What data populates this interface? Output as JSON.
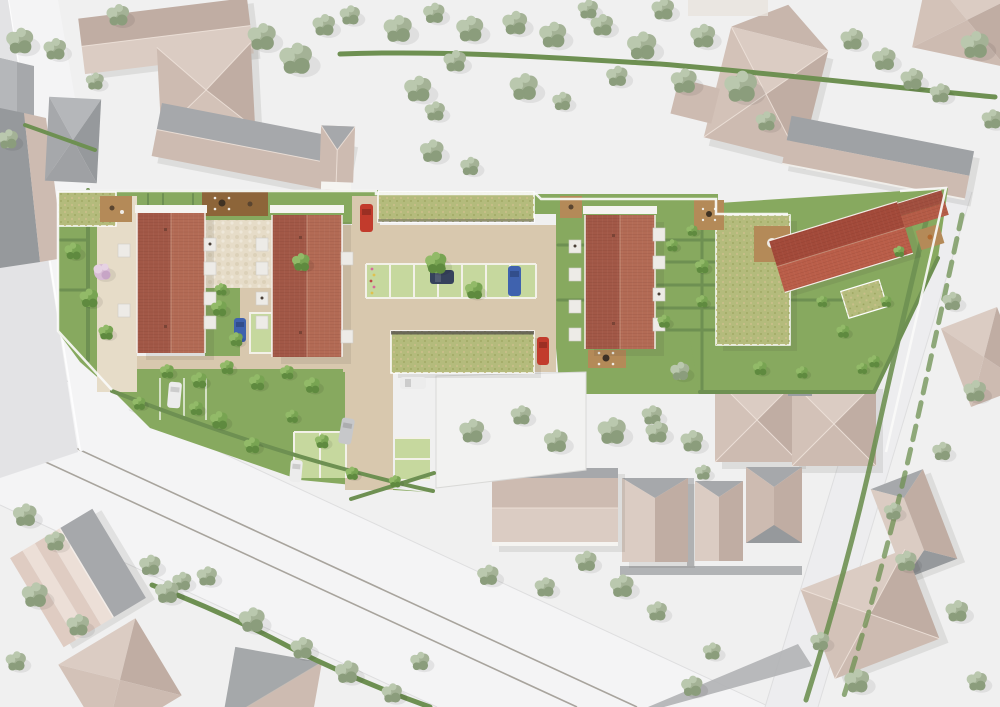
{
  "scene": {
    "kind": "aerial-site-plan-rendering",
    "description": "Top-down 3D rendering of a residential infill development: three red-tile-roof row houses, one diagonal red-roof house, green-roof carports, gardens, parking court with grass-paver stalls, surrounded by beige/gray neighbour roofs, roads (one with two tram rails) and many trees.",
    "site": {
      "red_roof_rowhouses": 3,
      "red_roof_diagonal_houses": 1,
      "red_roof_small_structures": 1,
      "green_roof_structures": 5,
      "wood_decks": 7,
      "grass_paver_stall_groups": 4
    },
    "neighborhood": {
      "neighbor_buildings": 23,
      "roads": 4,
      "tram_rails": 2
    },
    "vegetation": {
      "context_trees": 75,
      "site_trees": 36,
      "blossom_trees": 1,
      "hedge_lines": 14
    },
    "cars": [
      {
        "id": "car-1",
        "color": "car-red",
        "location": "north entry drive"
      },
      {
        "id": "car-2",
        "color": "car-red",
        "location": "east of carport"
      },
      {
        "id": "car-3",
        "color": "car-navy",
        "location": "parking stall under tree"
      },
      {
        "id": "car-4",
        "color": "car-blue",
        "location": "parking stall row"
      },
      {
        "id": "car-5",
        "color": "car-blue",
        "location": "courtyard garden stall"
      },
      {
        "id": "car-6",
        "color": "car-white",
        "location": "lawn stall below west rowhouse"
      },
      {
        "id": "car-7",
        "color": "car-white",
        "location": "west end of carport"
      },
      {
        "id": "car-8",
        "color": "car-silver",
        "location": "south drive"
      },
      {
        "id": "car-9",
        "color": "car-white",
        "location": "south stalls"
      }
    ]
  },
  "palette": {
    "ground": "#f0f0f0",
    "road": "#f4f4f5",
    "road-edge": "#dededf",
    "rail": "#a8a49d",
    "path-gray": "#b1b3b5",
    "roof-beige": "#cdbbb1",
    "roof-beige-light": "#dbccc3",
    "roof-beige-dark": "#c0ada3",
    "roof-beige-2": "#d3c2b8",
    "roof-gray": "#a6a8ab",
    "roof-gray-light": "#b5b7ba",
    "roof-gray-dark": "#96999c",
    "wall-white": "#f5f4f1",
    "red-dark": "#a25847",
    "red-light": "#b36b55",
    "red-deep": "#a34a3a",
    "red-deep2": "#ba5e49",
    "lawn": "#87a95f",
    "lawn-light": "#98b86e",
    "hedge": "#6e9052",
    "tree-ctx": "#a4b296",
    "tree-ctx-dark": "#8b9d7c",
    "tree-ctx-light": "#bac8ae",
    "tree-site": "#78a452",
    "tree-site-dark": "#5f8a3f",
    "tree-site-light": "#92ba68",
    "blossom": "#d8bcd4",
    "blossom-dark": "#c7a5c6",
    "green-roof": "#b4bb7c",
    "green-roof-tan": "#c8bf89",
    "pave": "#d8c8ae",
    "pave-light": "#e6dcc8",
    "stall": "#c6d89e",
    "stall-line": "#f3f1e8",
    "deck": "#b48a58",
    "deck-dark": "#8d6539",
    "car-red": "#c23b2c",
    "car-blue": "#3f62ae",
    "car-navy": "#36425c",
    "car-white": "#ececec",
    "car-silver": "#c7c8ca",
    "shadow": "#3c3c35"
  }
}
